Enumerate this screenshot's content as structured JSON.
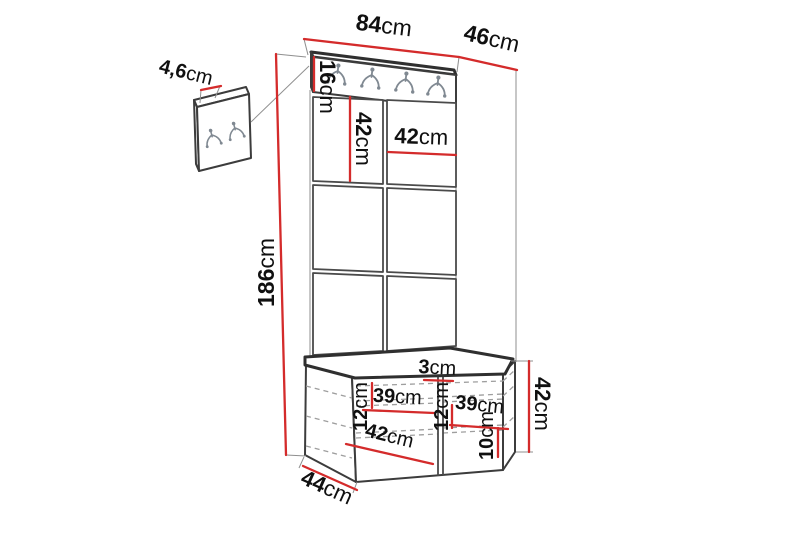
{
  "diagram": {
    "type": "furniture-dimension-drawing",
    "subject": "hallway wardrobe unit with coat-hook rail, upholstered wall panels and storage bench",
    "background_color": "#ffffff",
    "colors": {
      "dimension_line": "#d42b2b",
      "outline": "#3c3c3c",
      "hidden_line": "#9e9e9e",
      "hook_metal": "#808992",
      "label_text": "#101010"
    },
    "icons": {
      "rail_hook_count": 4,
      "detail_panel_hook_count": 2,
      "hook_icon": "double-coat-hook"
    }
  },
  "dims": {
    "detail_thickness": {
      "value": "4,6",
      "unit": "cm"
    },
    "total_width": {
      "value": "84",
      "unit": "cm"
    },
    "total_depth": {
      "value": "46",
      "unit": "cm"
    },
    "rail_height": {
      "value": "16",
      "unit": "cm"
    },
    "panel_height": {
      "value": "42",
      "unit": "cm"
    },
    "panel_width": {
      "value": "42",
      "unit": "cm"
    },
    "total_height": {
      "value": "186",
      "unit": "cm"
    },
    "divider_thickness": {
      "value": "3",
      "unit": "cm"
    },
    "shelf_gap_left": {
      "value": "12",
      "unit": "cm"
    },
    "inner_width_left": {
      "value": "39",
      "unit": "cm"
    },
    "shelf_gap_right": {
      "value": "12",
      "unit": "cm"
    },
    "inner_width_right": {
      "value": "39",
      "unit": "cm"
    },
    "bottom_gap": {
      "value": "10",
      "unit": "cm"
    },
    "bench_height": {
      "value": "42",
      "unit": "cm"
    },
    "bench_inner_depth": {
      "value": "42",
      "unit": "cm"
    },
    "bench_depth": {
      "value": "44",
      "unit": "cm"
    }
  }
}
